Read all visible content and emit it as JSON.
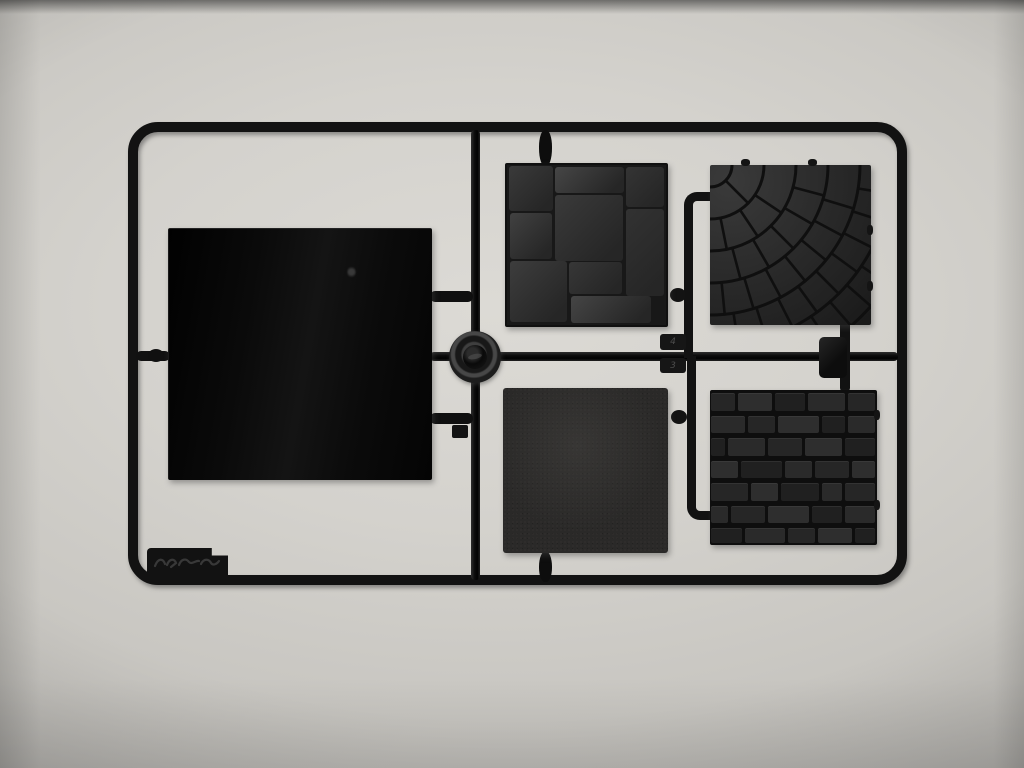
{
  "photo": {
    "subject": "black plastic injection-molded sprue with five square miniature terrain tiles on a light gray background",
    "background_hex": "#d4d2cd",
    "plastic_hex": "#121212"
  },
  "sprue": {
    "part_number_tabs": [
      {
        "label": "4"
      },
      {
        "label": "3"
      }
    ],
    "nubs": [
      {
        "x": 741,
        "y": 159,
        "w": 9,
        "h": 7
      },
      {
        "x": 808,
        "y": 159,
        "w": 9,
        "h": 7
      },
      {
        "x": 867,
        "y": 225,
        "w": 6,
        "h": 10
      },
      {
        "x": 867,
        "y": 281,
        "w": 6,
        "h": 10
      },
      {
        "x": 874,
        "y": 410,
        "w": 6,
        "h": 10
      },
      {
        "x": 874,
        "y": 500,
        "w": 6,
        "h": 10
      }
    ]
  },
  "tiles": {
    "large_blank": {
      "name": "large smooth glossy tile"
    },
    "flagstone": {
      "name": "flagstone paving tile",
      "groove_hex": "#161616",
      "stones": [
        {
          "x": 1.2,
          "y": 0.8,
          "w": 27.5,
          "h": 27.8,
          "shade": "#3a3a3a"
        },
        {
          "x": 30.0,
          "y": 1.0,
          "w": 43.5,
          "h": 16.5,
          "shade": "#464646"
        },
        {
          "x": 75.0,
          "y": 1.0,
          "w": 23.5,
          "h": 25.5,
          "shade": "#343434"
        },
        {
          "x": 1.8,
          "y": 30.2,
          "w": 26.8,
          "h": 28.5,
          "shade": "#414141"
        },
        {
          "x": 30.0,
          "y": 18.8,
          "w": 43.0,
          "h": 41.0,
          "shade": "#3a3a3a"
        },
        {
          "x": 75.0,
          "y": 27.8,
          "w": 23.5,
          "h": 54.0,
          "shade": "#323232"
        },
        {
          "x": 1.8,
          "y": 60.0,
          "w": 36.0,
          "h": 38.0,
          "shade": "#3d3d3d"
        },
        {
          "x": 39.0,
          "y": 60.8,
          "w": 33.5,
          "h": 20.0,
          "shade": "#373737"
        },
        {
          "x": 40.0,
          "y": 82.0,
          "w": 50.5,
          "h": 16.6,
          "shade": "#454545"
        }
      ]
    },
    "cobblestone": {
      "name": "fan-pattern cobblestone tile",
      "arc_radii": [
        22,
        54,
        86,
        118,
        150,
        182,
        214,
        246
      ],
      "joint_spacing": 27,
      "groove_hex": "#0f0f0f"
    },
    "plain": {
      "name": "plain textured tile"
    },
    "brick": {
      "name": "brick wall tile",
      "mortar_hex": "#0d0d0d",
      "row_heights": [
        14.8,
        14.2,
        14.8,
        14.2,
        14.8,
        14.2,
        13.0
      ],
      "rows": [
        [
          16,
          22,
          20,
          24,
          18
        ],
        [
          22,
          18,
          26,
          16,
          18
        ],
        [
          10,
          24,
          22,
          24,
          20
        ],
        [
          18,
          26,
          18,
          22,
          16
        ],
        [
          24,
          18,
          24,
          14,
          20
        ],
        [
          12,
          22,
          26,
          20,
          20
        ],
        [
          20,
          26,
          18,
          22,
          14
        ]
      ],
      "shades": [
        "#262626",
        "#2e2e2e",
        "#202020",
        "#2a2a2a"
      ]
    }
  }
}
